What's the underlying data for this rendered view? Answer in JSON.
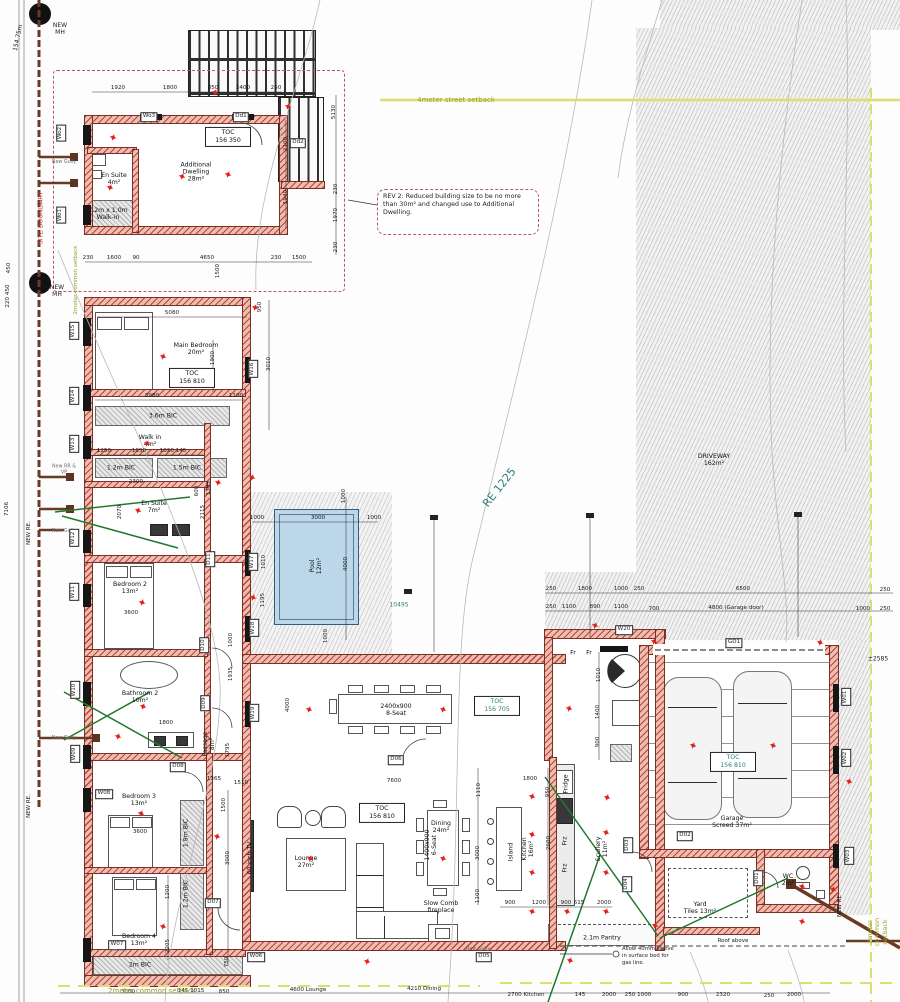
{
  "colors": {
    "wall": "#b9453a",
    "wall_fill": "#edbdb0",
    "pool": "#bcd7ea",
    "accent_red": "#e02518",
    "teal": "#2e7d7d",
    "olive": "#9c9c28",
    "sewer": "#6b3a26",
    "gas": "#1f7a2e"
  },
  "site": {
    "boundary_label": "SITE BOUNDARY",
    "boundary_length": "154.75m",
    "street_setback": "4meter street setback",
    "common_setback": "2meter common setback",
    "erf_label": "RE 1225",
    "driveway": "DRIVEWAY\n162m²",
    "overall_dim": "10495",
    "garage_offset": "±2585"
  },
  "notes": {
    "rev2": "REV 2: Reduced building size to be no more than 30m² and changed use to Additional Dwelling.",
    "gas": "Allow 40mm sleeve\nin surface bed for\ngas line.",
    "roof": "Roof above"
  },
  "room_labels": [
    [
      "Main Bedroom\n20m²",
      196,
      349,
      0
    ],
    [
      "Walk in\n4m²",
      150,
      441,
      0
    ],
    [
      "En Suite\n7m²",
      154,
      507,
      0
    ],
    [
      "Bedroom 2\n13m²",
      130,
      588,
      0
    ],
    [
      "Bathroom 2\n10m²",
      140,
      697,
      0
    ],
    [
      "Bedroom 3\n13m²",
      139,
      800,
      0
    ],
    [
      "Bedroom 4\n13m²",
      139,
      940,
      0
    ],
    [
      "Passage\n8m²",
      209,
      744,
      -90
    ],
    [
      "Lounge\n27m²",
      306,
      862,
      0
    ],
    [
      "Dining\n24m²",
      441,
      827,
      0
    ],
    [
      "Kitchen\n16m²",
      528,
      849,
      -90
    ],
    [
      "Island",
      511,
      852,
      -90
    ],
    [
      "Scullery\n11m²",
      602,
      849,
      -90
    ],
    [
      "Garage\nScreed 37m²",
      732,
      822,
      0
    ],
    [
      "Yard\nTiles 13m²",
      700,
      908,
      0
    ],
    [
      "WC\n2m²",
      788,
      880,
      0
    ],
    [
      "Additional\nDwelling\n28m²",
      196,
      172,
      0
    ],
    [
      "En Suite\n4m²",
      114,
      179,
      0
    ],
    [
      "DRIVEWAY\n162m²",
      714,
      460,
      0
    ],
    [
      "Pool\n12m²",
      316,
      566,
      -90
    ],
    [
      "3.6m BIC",
      163,
      416,
      0
    ],
    [
      "1.2m BIC",
      121,
      468,
      0
    ],
    [
      "1.5m BIC",
      187,
      468,
      0
    ],
    [
      "1.8m BIC",
      186,
      833,
      -90
    ],
    [
      "1.2m BIC",
      186,
      894,
      -90
    ],
    [
      "2m BIC",
      140,
      965,
      0
    ],
    [
      "1.2m x 1.0m\nWalk-in",
      108,
      214,
      0
    ],
    [
      "2.1m Pantry",
      602,
      938,
      0
    ],
    [
      "Slow Comb\nfireplace",
      441,
      907,
      0
    ],
    [
      "60 inch TV",
      250,
      858,
      -90
    ],
    [
      "Fridge",
      566,
      784,
      -90
    ],
    [
      "Frz",
      565,
      841,
      -90
    ],
    [
      "Frz",
      565,
      868,
      -90
    ],
    [
      "Fr",
      573,
      653,
      0
    ],
    [
      "Fr",
      589,
      653,
      0
    ],
    [
      "2400x900\n8-Seat",
      396,
      710,
      0
    ],
    [
      "1400x900\n6-Seat",
      431,
      845,
      -90
    ]
  ],
  "dim_labels": [
    [
      "1920",
      118,
      88,
      0
    ],
    [
      "1800",
      170,
      88,
      0
    ],
    [
      "850",
      213,
      88,
      0
    ],
    [
      "2400",
      243,
      88,
      0
    ],
    [
      "250",
      276,
      88,
      0
    ],
    [
      "5130",
      334,
      112,
      -90
    ],
    [
      "2100",
      286,
      144,
      -90
    ],
    [
      "1940",
      286,
      197,
      -90
    ],
    [
      "230",
      336,
      189,
      -90
    ],
    [
      "1970",
      336,
      215,
      -90
    ],
    [
      "230",
      336,
      247,
      -90
    ],
    [
      "230",
      88,
      258,
      0
    ],
    [
      "1600",
      114,
      258,
      0
    ],
    [
      "90",
      136,
      258,
      0
    ],
    [
      "4650",
      207,
      258,
      0
    ],
    [
      "230",
      276,
      258,
      0
    ],
    [
      "1500",
      299,
      258,
      0
    ],
    [
      "1500",
      218,
      271,
      -90
    ],
    [
      "5080",
      172,
      313,
      0
    ],
    [
      "3980",
      152,
      396,
      0
    ],
    [
      "1100",
      236,
      396,
      0
    ],
    [
      "1900",
      213,
      358,
      -90
    ],
    [
      "950",
      260,
      307,
      -90
    ],
    [
      "3010",
      269,
      364,
      -90
    ],
    [
      "1250",
      104,
      451,
      0
    ],
    [
      "1050",
      139,
      451,
      0
    ],
    [
      "1020 145",
      173,
      451,
      0
    ],
    [
      "2300",
      136,
      482,
      0
    ],
    [
      "2070",
      120,
      512,
      -90
    ],
    [
      "600",
      197,
      491,
      -90
    ],
    [
      "2115",
      203,
      512,
      -90
    ],
    [
      "1385",
      209,
      488,
      -90
    ],
    [
      "1000",
      257,
      518,
      0
    ],
    [
      "3000",
      318,
      518,
      0
    ],
    [
      "1000",
      374,
      518,
      0
    ],
    [
      "1000",
      344,
      496,
      -90
    ],
    [
      "4000",
      346,
      564,
      -90
    ],
    [
      "1010",
      264,
      562,
      -90
    ],
    [
      "1195",
      263,
      600,
      -90
    ],
    [
      "1000",
      326,
      636,
      -90
    ],
    [
      "3600",
      131,
      613,
      0
    ],
    [
      "1800",
      166,
      723,
      0
    ],
    [
      "3600",
      140,
      832,
      0
    ],
    [
      "1365",
      214,
      779,
      0
    ],
    [
      "1795",
      228,
      750,
      -90
    ],
    [
      "1935",
      231,
      674,
      -90
    ],
    [
      "1000",
      231,
      640,
      -90
    ],
    [
      "1200",
      168,
      892,
      -90
    ],
    [
      "2205",
      168,
      946,
      -90
    ],
    [
      "750",
      227,
      962,
      -90
    ],
    [
      "1500",
      224,
      805,
      -90
    ],
    [
      "3000",
      228,
      858,
      -90
    ],
    [
      "4000",
      288,
      705,
      -90
    ],
    [
      "7600",
      394,
      781,
      0
    ],
    [
      "1510",
      241,
      783,
      0
    ],
    [
      "1800",
      530,
      779,
      0
    ],
    [
      "1110",
      479,
      790,
      -90
    ],
    [
      "950",
      548,
      792,
      -90
    ],
    [
      "2600",
      549,
      843,
      -90
    ],
    [
      "3000",
      478,
      853,
      -90
    ],
    [
      "1100",
      478,
      896,
      -90
    ],
    [
      "900",
      510,
      903,
      0
    ],
    [
      "1200",
      539,
      903,
      0
    ],
    [
      "900",
      566,
      903,
      0
    ],
    [
      "615",
      579,
      903,
      0
    ],
    [
      "2000",
      604,
      903,
      0
    ],
    [
      "3000",
      128,
      992,
      0
    ],
    [
      "145 1015",
      191,
      991,
      0
    ],
    [
      "850",
      224,
      992,
      0
    ],
    [
      "4600 Lounge",
      308,
      990,
      0
    ],
    [
      "4210 Dining",
      424,
      989,
      0
    ],
    [
      "2700 Kitchen",
      526,
      995,
      0
    ],
    [
      "145",
      580,
      995,
      0
    ],
    [
      "2000",
      609,
      995,
      0
    ],
    [
      "250 1000",
      638,
      995,
      0
    ],
    [
      "900",
      683,
      995,
      0
    ],
    [
      "2320",
      723,
      995,
      0
    ],
    [
      "250",
      769,
      996,
      0
    ],
    [
      "2000",
      794,
      995,
      0
    ],
    [
      "250",
      551,
      589,
      0
    ],
    [
      "1800",
      585,
      589,
      0
    ],
    [
      "1000",
      621,
      589,
      0
    ],
    [
      "250",
      639,
      589,
      0
    ],
    [
      "6500",
      743,
      589,
      0
    ],
    [
      "250",
      885,
      590,
      0
    ],
    [
      "250",
      551,
      607,
      0
    ],
    [
      "1100",
      569,
      607,
      0
    ],
    [
      "890",
      595,
      607,
      0
    ],
    [
      "1100",
      621,
      607,
      0
    ],
    [
      "700",
      654,
      609,
      0
    ],
    [
      "4800 (Garage door)",
      736,
      608,
      0
    ],
    [
      "1000",
      863,
      609,
      0
    ],
    [
      "250",
      885,
      609,
      0
    ],
    [
      "1010",
      599,
      675,
      -90
    ],
    [
      "1400",
      598,
      712,
      -90
    ],
    [
      "900",
      598,
      742,
      -90
    ],
    [
      "450",
      9,
      268,
      -90
    ],
    [
      "220 450",
      8,
      296,
      -90
    ],
    [
      "7106",
      7,
      509,
      -90
    ]
  ],
  "opening_labels": [
    [
      "W15",
      74,
      331,
      -90
    ],
    [
      "W14",
      74,
      396,
      -90
    ],
    [
      "W13",
      74,
      444,
      -90
    ],
    [
      "W12",
      74,
      538,
      -90
    ],
    [
      "W11",
      74,
      592,
      -90
    ],
    [
      "W10",
      75,
      690,
      -90
    ],
    [
      "W09",
      75,
      754,
      -90
    ],
    [
      "W08",
      104,
      794,
      0
    ],
    [
      "W07",
      117,
      945,
      0
    ],
    [
      "W06",
      256,
      957,
      0
    ],
    [
      "W16",
      253,
      369,
      -90
    ],
    [
      "W17",
      253,
      562,
      -90
    ],
    [
      "W18",
      254,
      628,
      -90
    ],
    [
      "W19",
      254,
      713,
      -90
    ],
    [
      "W20",
      624,
      630,
      0
    ],
    [
      "W01",
      846,
      697,
      -90
    ],
    [
      "W02",
      846,
      758,
      -90
    ],
    [
      "W03",
      849,
      856,
      -90
    ],
    [
      "Wo2",
      61,
      133,
      -90
    ],
    [
      "Wo1",
      61,
      215,
      -90
    ],
    [
      "Wo3",
      149,
      117,
      0
    ],
    [
      "Dd1",
      241,
      117,
      0
    ],
    [
      "Dd2",
      298,
      143,
      0
    ],
    [
      "D01",
      758,
      878,
      -90
    ],
    [
      "D02",
      685,
      836,
      0
    ],
    [
      "D03",
      628,
      845,
      -90
    ],
    [
      "D04",
      627,
      884,
      -90
    ],
    [
      "D05",
      484,
      957,
      0
    ],
    [
      "D06",
      396,
      760,
      0
    ],
    [
      "D07",
      213,
      903,
      0
    ],
    [
      "D08",
      178,
      767,
      0
    ],
    [
      "D09",
      205,
      703,
      -90
    ],
    [
      "D10",
      204,
      645,
      -90
    ],
    [
      "D11",
      210,
      559,
      -90
    ],
    [
      "GD1",
      734,
      643,
      0
    ]
  ],
  "toc_markers": [
    [
      "156 350",
      228,
      137,
      0
    ],
    [
      "156 810",
      192,
      378,
      0
    ],
    [
      "156 705",
      497,
      706,
      1
    ],
    [
      "156 810",
      382,
      813,
      0
    ],
    [
      "156 810",
      733,
      762,
      1
    ]
  ],
  "annotations": [
    [
      "NEW\nMH",
      60,
      30,
      0,
      "",
      6
    ],
    [
      "NEW\nMH",
      57,
      292,
      0,
      "",
      6
    ],
    [
      "SITE BOUNDARY",
      41,
      218,
      -90,
      "red",
      6.5
    ],
    [
      "NEW RE.",
      29,
      533,
      -90,
      "",
      5.5
    ],
    [
      "NEW RE.",
      29,
      806,
      -90,
      "",
      5.5
    ],
    [
      "NEW RE",
      840,
      906,
      -90,
      "",
      5.5
    ],
    [
      "New Gully",
      64,
      163,
      0,
      "gray",
      4.8
    ],
    [
      "New RR &\nVP",
      64,
      470,
      0,
      "gray",
      4.8
    ],
    [
      "New Gully",
      64,
      532,
      0,
      "gray",
      4.8
    ],
    [
      "New Gully",
      64,
      739,
      0,
      "gray",
      4.8
    ],
    [
      "New Gully",
      478,
      950,
      0,
      "gray",
      4.8
    ],
    [
      "154.75m",
      19,
      38,
      -78,
      "",
      6
    ],
    [
      "RE 1225",
      500,
      488,
      -52,
      "teal",
      11
    ],
    [
      "10495",
      399,
      606,
      0,
      "teal",
      6
    ],
    [
      "±2585",
      878,
      660,
      0,
      "",
      6
    ],
    [
      "4meter street setback",
      456,
      100,
      0,
      "olive",
      7
    ],
    [
      "2meter common setback",
      152,
      991,
      0,
      "olive",
      7
    ],
    [
      "2meter common setback",
      878,
      932,
      -90,
      "olive",
      6.5
    ],
    [
      "2meter common setback",
      76,
      280,
      -90,
      "olive",
      5.5
    ],
    [
      "Roof above",
      733,
      941,
      0,
      "",
      5.5
    ]
  ],
  "stars": [
    [
      215,
      93
    ],
    [
      288,
      107
    ],
    [
      113,
      138
    ],
    [
      182,
      177
    ],
    [
      228,
      175
    ],
    [
      110,
      188
    ],
    [
      163,
      357
    ],
    [
      255,
      308
    ],
    [
      147,
      444
    ],
    [
      138,
      511
    ],
    [
      218,
      483
    ],
    [
      252,
      478
    ],
    [
      142,
      603
    ],
    [
      253,
      598
    ],
    [
      143,
      707
    ],
    [
      118,
      737
    ],
    [
      141,
      814
    ],
    [
      217,
      837
    ],
    [
      163,
      927
    ],
    [
      309,
      710
    ],
    [
      443,
      710
    ],
    [
      310,
      859
    ],
    [
      443,
      859
    ],
    [
      367,
      962
    ],
    [
      532,
      797
    ],
    [
      532,
      835
    ],
    [
      532,
      873
    ],
    [
      607,
      798
    ],
    [
      606,
      833
    ],
    [
      606,
      873
    ],
    [
      532,
      912
    ],
    [
      567,
      912
    ],
    [
      606,
      912
    ],
    [
      570,
      961
    ],
    [
      595,
      626
    ],
    [
      569,
      709
    ],
    [
      693,
      746
    ],
    [
      773,
      746
    ],
    [
      849,
      782
    ],
    [
      654,
      642
    ],
    [
      820,
      643
    ],
    [
      655,
      926
    ],
    [
      802,
      887
    ],
    [
      802,
      922
    ],
    [
      833,
      890
    ]
  ]
}
